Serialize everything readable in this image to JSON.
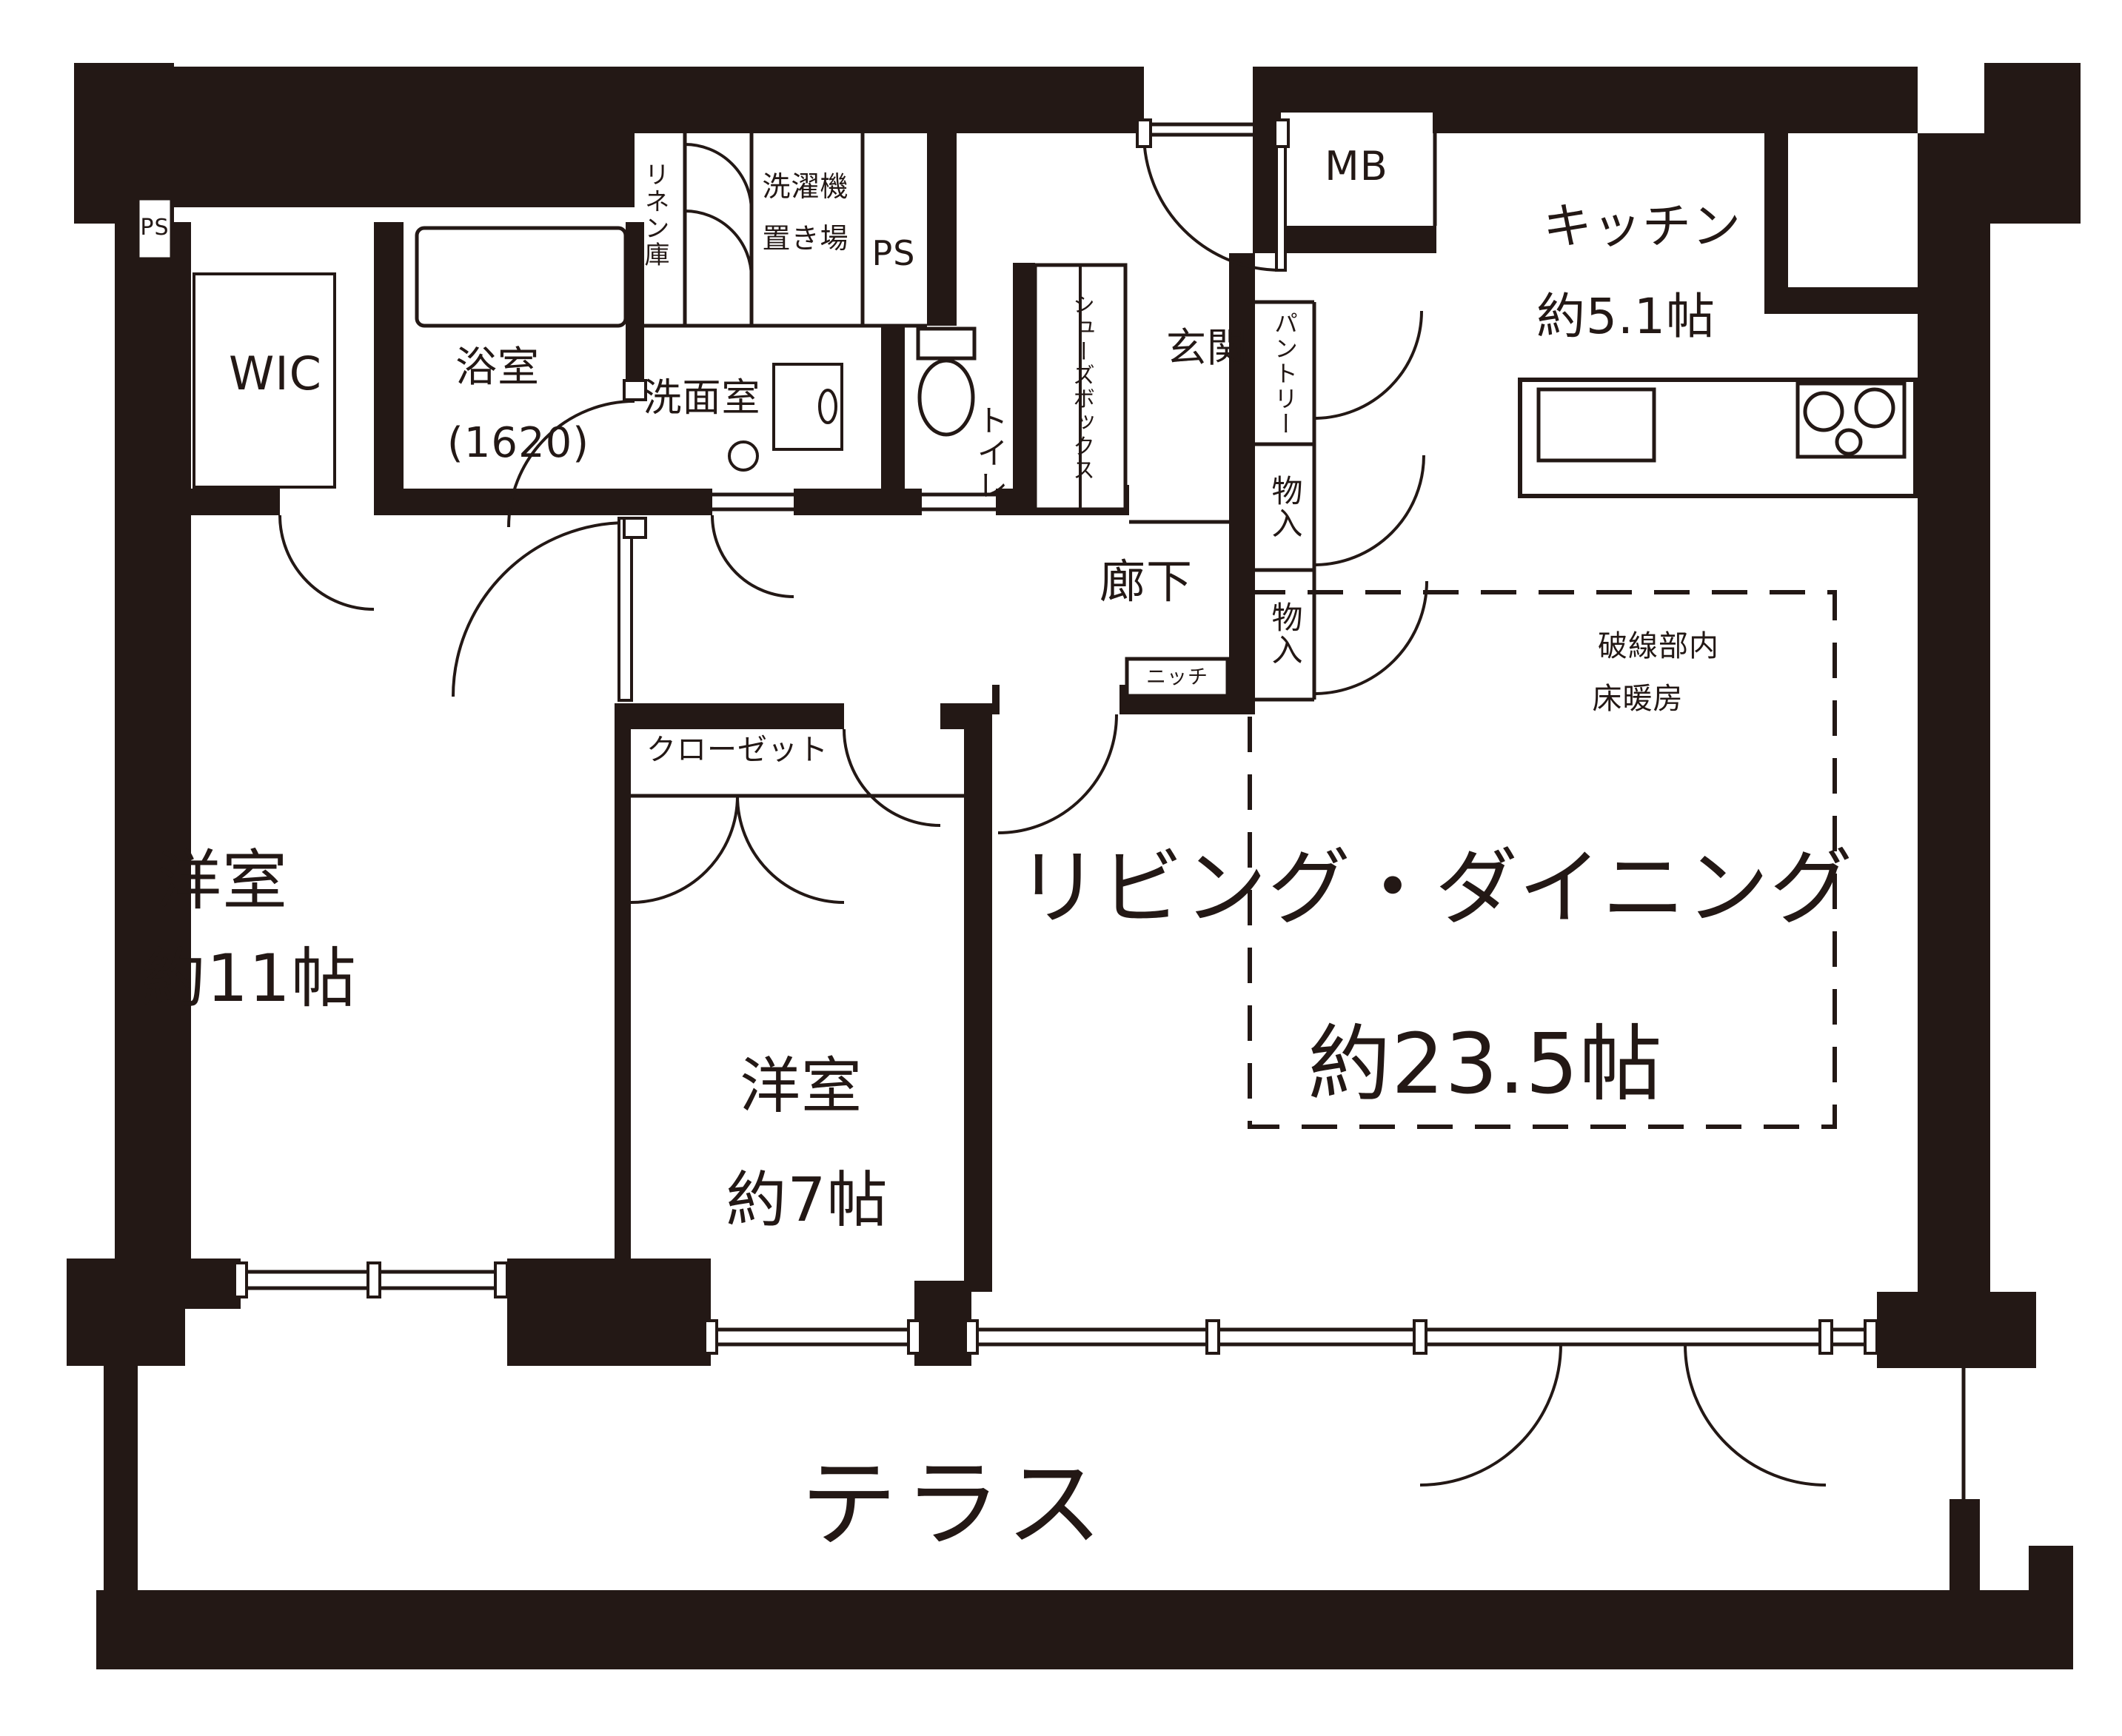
{
  "plan_type": "floor_plan",
  "colors": {
    "ink": "#231815",
    "paper": "#ffffff"
  },
  "labels": {
    "ps_left": "PS",
    "wic": "WIC",
    "bath_name": "浴室",
    "bath_size": "(1620)",
    "linen": "リネン庫",
    "laundry_line1": "洗濯機",
    "laundry_line2": "置き場",
    "ps_top": "PS",
    "washroom": "洗面室",
    "toilet": "トイレ",
    "shoebox": "シューズボックス",
    "genkan": "玄関",
    "mb": "MB",
    "pantry": "パントリー",
    "storage_upper": "物入",
    "storage_lower": "物入",
    "corridor": "廊下",
    "niche": "ニッチ",
    "kitchen_name": "キッチン",
    "kitchen_area": "約5.1帖",
    "living_name": "リビング・ダイニング",
    "living_area": "約23.5帖",
    "heating_line1": "破線部内",
    "heating_line2": "床暖房",
    "bed11_name": "洋室",
    "bed11_area": "約11帖",
    "bed7_name": "洋室",
    "bed7_area": "約7帖",
    "closet": "クローゼット",
    "terrace": "テラス"
  }
}
